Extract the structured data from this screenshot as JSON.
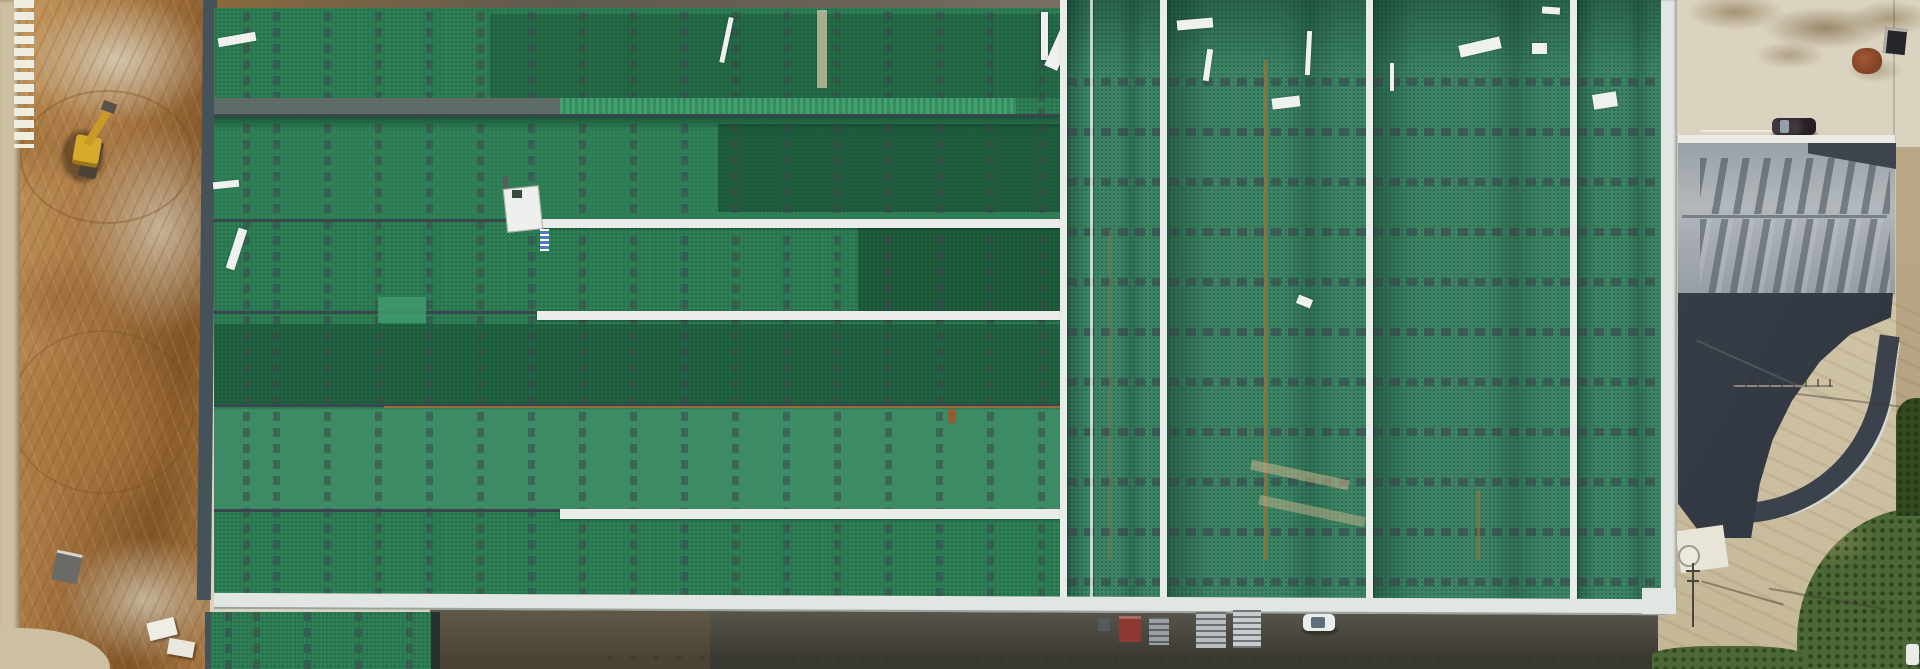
{
  "scene": {
    "type": "aerial-photograph",
    "description": "Top-down drone photo of a large industrial warehouse with a green metal roof under construction: graded bare earth with a wheel loader on the left, vent strips and white ridge caps on the green roof, a gray gable-roofed secondary building with a charcoal lower roof on the right, a curved concrete access road, a dark service drive with pallets, a red container and parked cars along the south side, and brush at the lower-right corner",
    "labels": {
      "dirt_area": "graded earth construction ground",
      "main_roof": "green standing-seam warehouse roof with dashed vent strips",
      "annex_roof": "lower green annex roof section",
      "secondary_building": "gray gable-roof building with charcoal lower roof",
      "access_road": "curved light concrete access road",
      "service_yard": "stained concrete yard",
      "asphalt_drive": "dark asphalt drive on south side",
      "vegetation": "trees and brush at lower right"
    }
  },
  "palette": {
    "dirt_base": "#aa7a45",
    "dirt_dark": "#835526",
    "dirt_light": "#c89c63",
    "gravel": "#d2c8b2",
    "road_tan": "#cdc0a2",
    "asphalt": "#4d4b42",
    "asphalt_dark": "#393831",
    "roof_green_a": "#2e7e55",
    "roof_green_b": "#31825a",
    "roof_green_teal": "#3f8e68",
    "roof_green_dark": "#275f44",
    "roof_right_green": "#3c8465",
    "ridge_gray": "#5f6b66",
    "ridge_line": "#39464e",
    "cap_white": "#e9ece8",
    "ribbed_light": "#43a06f",
    "ribbed_dark": "#358c5d",
    "rust": "#a96f33",
    "eave_white": "#e2e6e2",
    "concrete": "#dad3c0",
    "stain": "#94805a",
    "roof2_light": "#a7adb2",
    "roof2_dark": "#3e444b",
    "roof2_charcoal": "#333943",
    "veg": "#4c6836",
    "veg_dark": "#33491f",
    "loader_yellow": "#d9a92c",
    "car_white": "#ebedec",
    "car_dark": "#423940",
    "container_red": "#8d3832",
    "pallet_gray": "#b9bec1",
    "glass": "#93a0a8"
  },
  "objects": [
    {
      "label": "yellow wheel loader",
      "approx_box": [
        70,
        105,
        50,
        80
      ]
    },
    {
      "label": "white car parked on south drive",
      "approx_box": [
        1303,
        614,
        32,
        17
      ]
    },
    {
      "label": "dark car parked on east yard",
      "approx_box": [
        1772,
        118,
        44,
        17
      ]
    },
    {
      "label": "red container",
      "approx_box": [
        1119,
        616,
        22,
        26
      ]
    },
    {
      "label": "pallet stacks",
      "approx_box": [
        1149,
        610,
        114,
        38
      ]
    },
    {
      "label": "rooftop hatch unit",
      "approx_box": [
        505,
        178,
        40,
        55
      ]
    },
    {
      "label": "utility cabinet",
      "approx_box": [
        1678,
        78,
        15,
        44
      ]
    },
    {
      "label": "waste bin",
      "approx_box": [
        1884,
        28,
        22,
        26
      ]
    },
    {
      "label": "rust-colored debris pile",
      "approx_box": [
        1852,
        48,
        30,
        26
      ]
    },
    {
      "label": "white stone block row",
      "approx_box": [
        14,
        0,
        20,
        148
      ]
    },
    {
      "label": "white blocks near south-west corner",
      "approx_box": [
        148,
        620,
        48,
        38
      ]
    },
    {
      "label": "power pole with shadow",
      "approx_box": [
        1686,
        563,
        18,
        66
      ]
    },
    {
      "label": "white pad with round tank",
      "approx_box": [
        1678,
        528,
        48,
        42
      ]
    }
  ]
}
